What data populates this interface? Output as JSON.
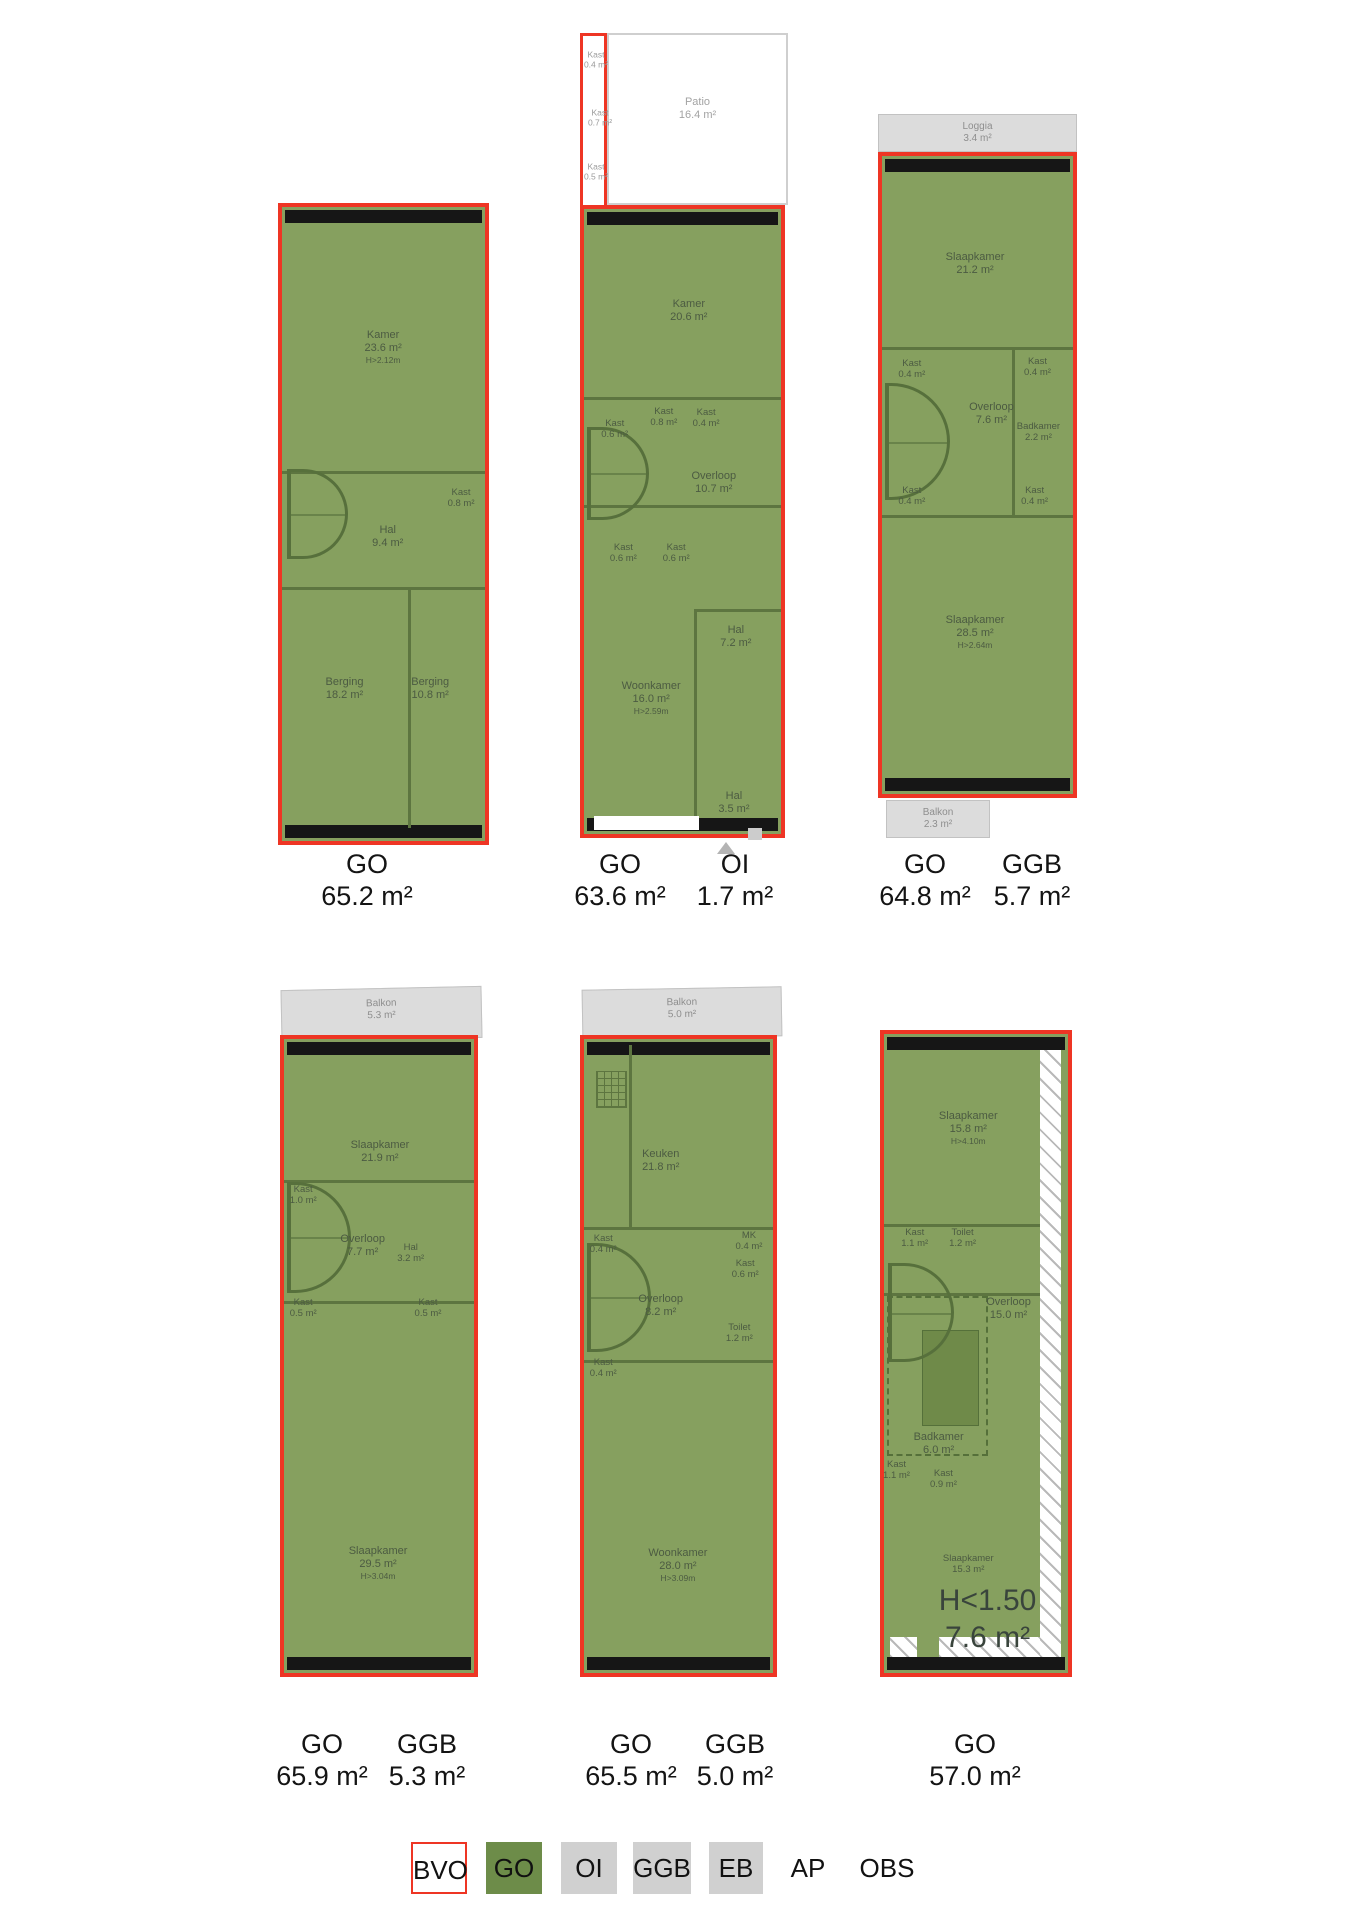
{
  "document": {
    "type": "NEN2580 measurement floor plans"
  },
  "colors": {
    "go_green": "#6d8c49",
    "plan_fill": "#86a05f",
    "bvo_red": "#ee3524",
    "annex_grey": "#dcdcdc",
    "legend_grey": "#d0d0d0",
    "black_wall": "#161616"
  },
  "plans": [
    {
      "id": "plan-1",
      "measures": [
        {
          "code": "GO",
          "value": "65.2 m²"
        }
      ],
      "rooms": [
        {
          "name": "Kamer",
          "area": "23.6 m²",
          "note": "H>2.12m"
        },
        {
          "name": "Hal",
          "area": "9.4 m²"
        },
        {
          "name": "Kast",
          "area": "0.8 m²"
        },
        {
          "name": "Berging",
          "area": "18.2 m²"
        },
        {
          "name": "Berging",
          "area": "10.8 m²"
        }
      ]
    },
    {
      "id": "plan-2",
      "measures": [
        {
          "code": "GO",
          "value": "63.6 m²"
        },
        {
          "code": "OI",
          "value": "1.7 m²"
        }
      ],
      "strip_rooms": [
        {
          "name": "Kast",
          "area": "0.4 m²"
        },
        {
          "name": "Kast",
          "area": "0.7 m²"
        },
        {
          "name": "Kast",
          "area": "0.5 m²"
        }
      ],
      "patio": {
        "name": "Patio",
        "area": "16.4 m²"
      },
      "rooms": [
        {
          "name": "Kamer",
          "area": "20.6 m²"
        },
        {
          "name": "Kast",
          "area": "0.6 m²"
        },
        {
          "name": "Kast",
          "area": "0.8 m²"
        },
        {
          "name": "Kast",
          "area": "0.4 m²"
        },
        {
          "name": "Overloop",
          "area": "10.7 m²"
        },
        {
          "name": "Kast",
          "area": "0.6 m²"
        },
        {
          "name": "Kast",
          "area": "0.6 m²"
        },
        {
          "name": "Hal",
          "area": "7.2 m²"
        },
        {
          "name": "Woonkamer",
          "area": "16.0 m²",
          "note": "H>2.59m"
        },
        {
          "name": "Hal",
          "area": "3.5 m²"
        }
      ]
    },
    {
      "id": "plan-3",
      "measures": [
        {
          "code": "GO",
          "value": "64.8 m²"
        },
        {
          "code": "GGB",
          "value": "5.7 m²"
        }
      ],
      "loggia": {
        "name": "Loggia",
        "area": "3.4 m²"
      },
      "balkon": {
        "name": "Balkon",
        "area": "2.3 m²"
      },
      "rooms": [
        {
          "name": "Slaapkamer",
          "area": "21.2 m²"
        },
        {
          "name": "Kast",
          "area": "0.4 m²"
        },
        {
          "name": "Kast",
          "area": "0.4 m²"
        },
        {
          "name": "Overloop",
          "area": "7.6 m²"
        },
        {
          "name": "Badkamer",
          "area": "2.2 m²"
        },
        {
          "name": "Kast",
          "area": "0.4 m²"
        },
        {
          "name": "Kast",
          "area": "0.4 m²"
        },
        {
          "name": "Slaapkamer",
          "area": "28.5 m²",
          "note": "H>2.64m"
        }
      ]
    },
    {
      "id": "plan-4",
      "measures": [
        {
          "code": "GO",
          "value": "65.9 m²"
        },
        {
          "code": "GGB",
          "value": "5.3 m²"
        }
      ],
      "balkon": {
        "name": "Balkon",
        "area": "5.3 m²"
      },
      "rooms": [
        {
          "name": "Slaapkamer",
          "area": "21.9 m²"
        },
        {
          "name": "Kast",
          "area": "1.0 m²"
        },
        {
          "name": "Overloop",
          "area": "7.7 m²"
        },
        {
          "name": "Hal",
          "area": "3.2 m²"
        },
        {
          "name": "Kast",
          "area": "0.5 m²"
        },
        {
          "name": "Kast",
          "area": "0.5 m²"
        },
        {
          "name": "Slaapkamer",
          "area": "29.5 m²",
          "note": "H>3.04m"
        }
      ]
    },
    {
      "id": "plan-5",
      "measures": [
        {
          "code": "GO",
          "value": "65.5 m²"
        },
        {
          "code": "GGB",
          "value": "5.0 m²"
        }
      ],
      "balkon": {
        "name": "Balkon",
        "area": "5.0 m²"
      },
      "rooms": [
        {
          "name": "Keuken",
          "area": "21.8 m²"
        },
        {
          "name": "Kast",
          "area": "0.4 m²"
        },
        {
          "name": "MK",
          "area": "0.4 m²"
        },
        {
          "name": "Kast",
          "area": "0.6 m²"
        },
        {
          "name": "Overloop",
          "area": "8.2 m²"
        },
        {
          "name": "Toilet",
          "area": "1.2 m²"
        },
        {
          "name": "Kast",
          "area": "0.4 m²"
        },
        {
          "name": "Woonkamer",
          "area": "28.0 m²",
          "note": "H>3.09m"
        }
      ]
    },
    {
      "id": "plan-6",
      "measures": [
        {
          "code": "GO",
          "value": "57.0 m²"
        }
      ],
      "rooms": [
        {
          "name": "Slaapkamer",
          "area": "15.8 m²",
          "note": "H>4.10m"
        },
        {
          "name": "Kast",
          "area": "1.1 m²"
        },
        {
          "name": "Toilet",
          "area": "1.2 m²"
        },
        {
          "name": "Overloop",
          "area": "15.0 m²"
        },
        {
          "name": "Badkamer",
          "area": "6.0 m²"
        },
        {
          "name": "Kast",
          "area": "1.1 m²"
        },
        {
          "name": "Kast",
          "area": "0.9 m²"
        },
        {
          "name": "Slaapkamer",
          "area": "15.3 m²"
        }
      ],
      "low_height": {
        "label": "H<1.50",
        "area": "7.6 m²"
      }
    }
  ],
  "legend": {
    "items": [
      {
        "label": "BVO",
        "swatch": "red-outline"
      },
      {
        "label": "GO",
        "swatch": "green"
      },
      {
        "label": "OI",
        "swatch": "grey"
      },
      {
        "label": "GGB",
        "swatch": "grey"
      },
      {
        "label": "EB",
        "swatch": "grey"
      },
      {
        "label": "AP",
        "swatch": "none"
      },
      {
        "label": "OBS",
        "swatch": "none"
      }
    ]
  }
}
